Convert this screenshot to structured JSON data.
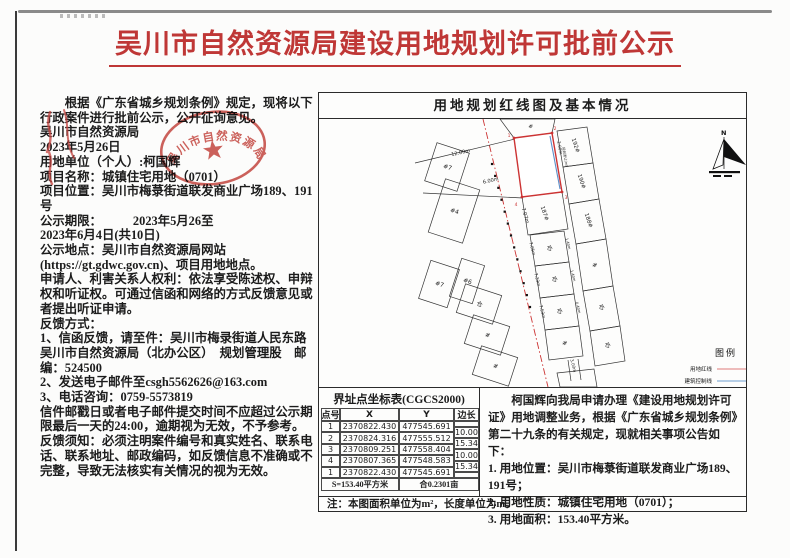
{
  "title": "吴川市自然资源局建设用地规划许可批前公示",
  "colors": {
    "accent_red": "#bf3736",
    "map_redline": "#cc3333",
    "map_blueline": "#5b8fc9"
  },
  "body": {
    "paragraphs": [
      {
        "cls": "indent",
        "text": "根据《广东省城乡规划条例》规定，现将以下行政案件进行批前公示，公开征询意见。"
      },
      {
        "cls": "sig",
        "text": "吴川市自然资源局"
      },
      {
        "cls": "sig2",
        "text": "2023年5月26日"
      },
      {
        "cls": "field",
        "text": "用地单位（个人）:柯国辉"
      },
      {
        "cls": "field",
        "text": "项目名称：城镇住宅用地（0701）"
      },
      {
        "cls": "field",
        "text": "项目位置：吴川市梅菉街道联发商业广场189、191号"
      },
      {
        "cls": "field",
        "text": "公示期限：　　　2023年5月26至"
      },
      {
        "cls": "date2",
        "text": "2023年6月4日(共10日)"
      },
      {
        "cls": "field",
        "text": "公示地点：吴川市自然资源局网站(https://gt.gdwc.gov.cn)、项目用地地点。"
      },
      {
        "cls": "field",
        "text": "申请人、利害关系人权利：依法享受陈述权、申辩权和听证权。可通过信函和网络的方式反馈意见或者提出听证申请。"
      },
      {
        "cls": "field",
        "text": "反馈方式："
      },
      {
        "cls": "field",
        "text": "1、信函反馈，请至件：吴川市梅录街道人民东路吴川市自然资源局（北办公区）　规划管理股　邮编：524500"
      },
      {
        "cls": "field",
        "text": "2、发送电子邮件至csgh5562626@163.com"
      },
      {
        "cls": "field",
        "text": "3、电话咨询：0759-5573819"
      },
      {
        "cls": "field",
        "text": "信件邮戳日或者电子邮件提交时间不应超过公示期限最后一天的24:00，逾期视为无效，不予参考。"
      },
      {
        "cls": "field",
        "text": "反馈须知：必须注明案件编号和真实姓名、联系电话、联系地址、邮政编码，如反馈信息不准确或不完整，导致无法核实有关情况的视为无效。"
      }
    ]
  },
  "stamp": {
    "text": "吴川市自然资源局"
  },
  "panel": {
    "title": "用地规划红线图及基本情况",
    "map": {
      "north_label": "N",
      "legend": {
        "title": "图例",
        "items": [
          {
            "label": "用地红线",
            "color": "#e07a7a"
          },
          {
            "label": "建筑控制线",
            "color": "#6f9fd0"
          }
        ]
      },
      "labels": [
        {
          "t": "12.00m",
          "x": 142,
          "y": 35,
          "r": -13,
          "s": 5
        },
        {
          "t": "6.00m",
          "x": 172,
          "y": 63,
          "r": -13,
          "s": 5
        },
        {
          "t": "7.07m",
          "x": 205,
          "y": 97,
          "r": 73,
          "s": 5
        },
        {
          "t": "2.00m",
          "x": 239.5,
          "y": 29,
          "r": 80,
          "s": 4.2
        },
        {
          "t": "规划退让(m)",
          "x": 245,
          "y": 38,
          "r": 80,
          "s": 3.4
        },
        {
          "t": "192#",
          "x": 255,
          "y": 27,
          "r": 72,
          "s": 5.5
        },
        {
          "t": "190#",
          "x": 261,
          "y": 63,
          "r": 72,
          "s": 5.5
        },
        {
          "t": "188#",
          "x": 268,
          "y": 102,
          "r": 72,
          "s": 5.5
        },
        {
          "t": "187#",
          "x": 224,
          "y": 95,
          "r": 72,
          "s": 5.5
        },
        {
          "t": "仓",
          "x": 230,
          "y": 131,
          "r": 20,
          "s": 6
        },
        {
          "t": "7.05m",
          "x": 212,
          "y": 130,
          "r": 75,
          "s": 4.2
        },
        {
          "t": "1.40m",
          "x": 248,
          "y": 125,
          "r": 75,
          "s": 3.6
        },
        {
          "t": "仓",
          "x": 235,
          "y": 162,
          "r": 20,
          "s": 6
        },
        {
          "t": "7.33m",
          "x": 217,
          "y": 161,
          "r": 75,
          "s": 4.2
        },
        {
          "t": "1.40m",
          "x": 253,
          "y": 157,
          "r": 75,
          "s": 3.6
        },
        {
          "t": "仓",
          "x": 240,
          "y": 194,
          "r": 20,
          "s": 6
        },
        {
          "t": "7.53m",
          "x": 222,
          "y": 193,
          "r": 75,
          "s": 4.2
        },
        {
          "t": "0.40m",
          "x": 258,
          "y": 189,
          "r": 75,
          "s": 3.6
        },
        {
          "t": "#",
          "x": 275,
          "y": 148,
          "r": 20,
          "s": 6
        },
        {
          "t": "仓",
          "x": 282,
          "y": 190,
          "r": 20,
          "s": 6
        },
        {
          "t": "#",
          "x": 245,
          "y": 226,
          "r": 20,
          "s": 6
        },
        {
          "t": "仓",
          "x": 288,
          "y": 228,
          "r": 20,
          "s": 6
        },
        {
          "t": "3.00m",
          "x": 253,
          "y": 247,
          "r": 75,
          "s": 4.2
        },
        {
          "t": "#",
          "x": 211,
          "y": 9,
          "r": 20,
          "s": 5.5
        },
        {
          "t": "#7",
          "x": 128,
          "y": 50,
          "r": 18,
          "s": 6
        },
        {
          "t": "#4",
          "x": 135,
          "y": 94,
          "r": 18,
          "s": 6
        },
        {
          "t": "#7",
          "x": 120,
          "y": 167,
          "r": 18,
          "s": 6
        },
        {
          "t": "#6",
          "x": 148,
          "y": 164,
          "r": 18,
          "s": 6
        },
        {
          "t": "仓",
          "x": 160,
          "y": 187,
          "r": 18,
          "s": 6
        },
        {
          "t": "#",
          "x": 168,
          "y": 218,
          "r": 18,
          "s": 6
        },
        {
          "t": "#",
          "x": 176,
          "y": 249,
          "r": 18,
          "s": 6
        },
        {
          "t": "1",
          "x": 190,
          "y": 18,
          "r": 0,
          "s": 4.5,
          "c": "#cc3333"
        },
        {
          "t": "2",
          "x": 236,
          "y": 11,
          "r": 0,
          "s": 4.5,
          "c": "#cc3333"
        },
        {
          "t": "3",
          "x": 247,
          "y": 80,
          "r": 0,
          "s": 4.5,
          "c": "#cc3333"
        },
        {
          "t": "4",
          "x": 197,
          "y": 87,
          "r": 0,
          "s": 4.5,
          "c": "#cc3333"
        }
      ]
    },
    "boundary_table": {
      "title": "界址点坐标表(CGCS2000)",
      "headers": [
        "点号",
        "X",
        "Y",
        "边长"
      ],
      "points": [
        {
          "id": "1",
          "x": "2370822.430",
          "y": "477545.691"
        },
        {
          "id": "2",
          "x": "2370824.316",
          "y": "477555.512"
        },
        {
          "id": "3",
          "x": "2370809.251",
          "y": "477558.404"
        },
        {
          "id": "4",
          "x": "2370807.365",
          "y": "477548.583"
        },
        {
          "id": "1",
          "x": "2370822.430",
          "y": "477545.691"
        }
      ],
      "side_lengths": [
        "10.00",
        "15.34",
        "10.00",
        "15.34"
      ],
      "area_summary": "S=153.40平方米",
      "area_mu": "合0.2301亩"
    },
    "announcement": {
      "para": "柯国辉向我局申请办理《建设用地规划许可证》用地调整业务，根据《广东省城乡规划条例》第二十九条的有关规定，现就相关事项公告如下：",
      "items": [
        "1. 用地位置：吴川市梅菉街道联发商业广场189、191号；",
        "2. 用地性质：城镇住宅用地（0701）；",
        "3. 用地面积：153.40平方米。"
      ]
    },
    "note": "注：本图面积单位为m²，长度单位为m。"
  }
}
